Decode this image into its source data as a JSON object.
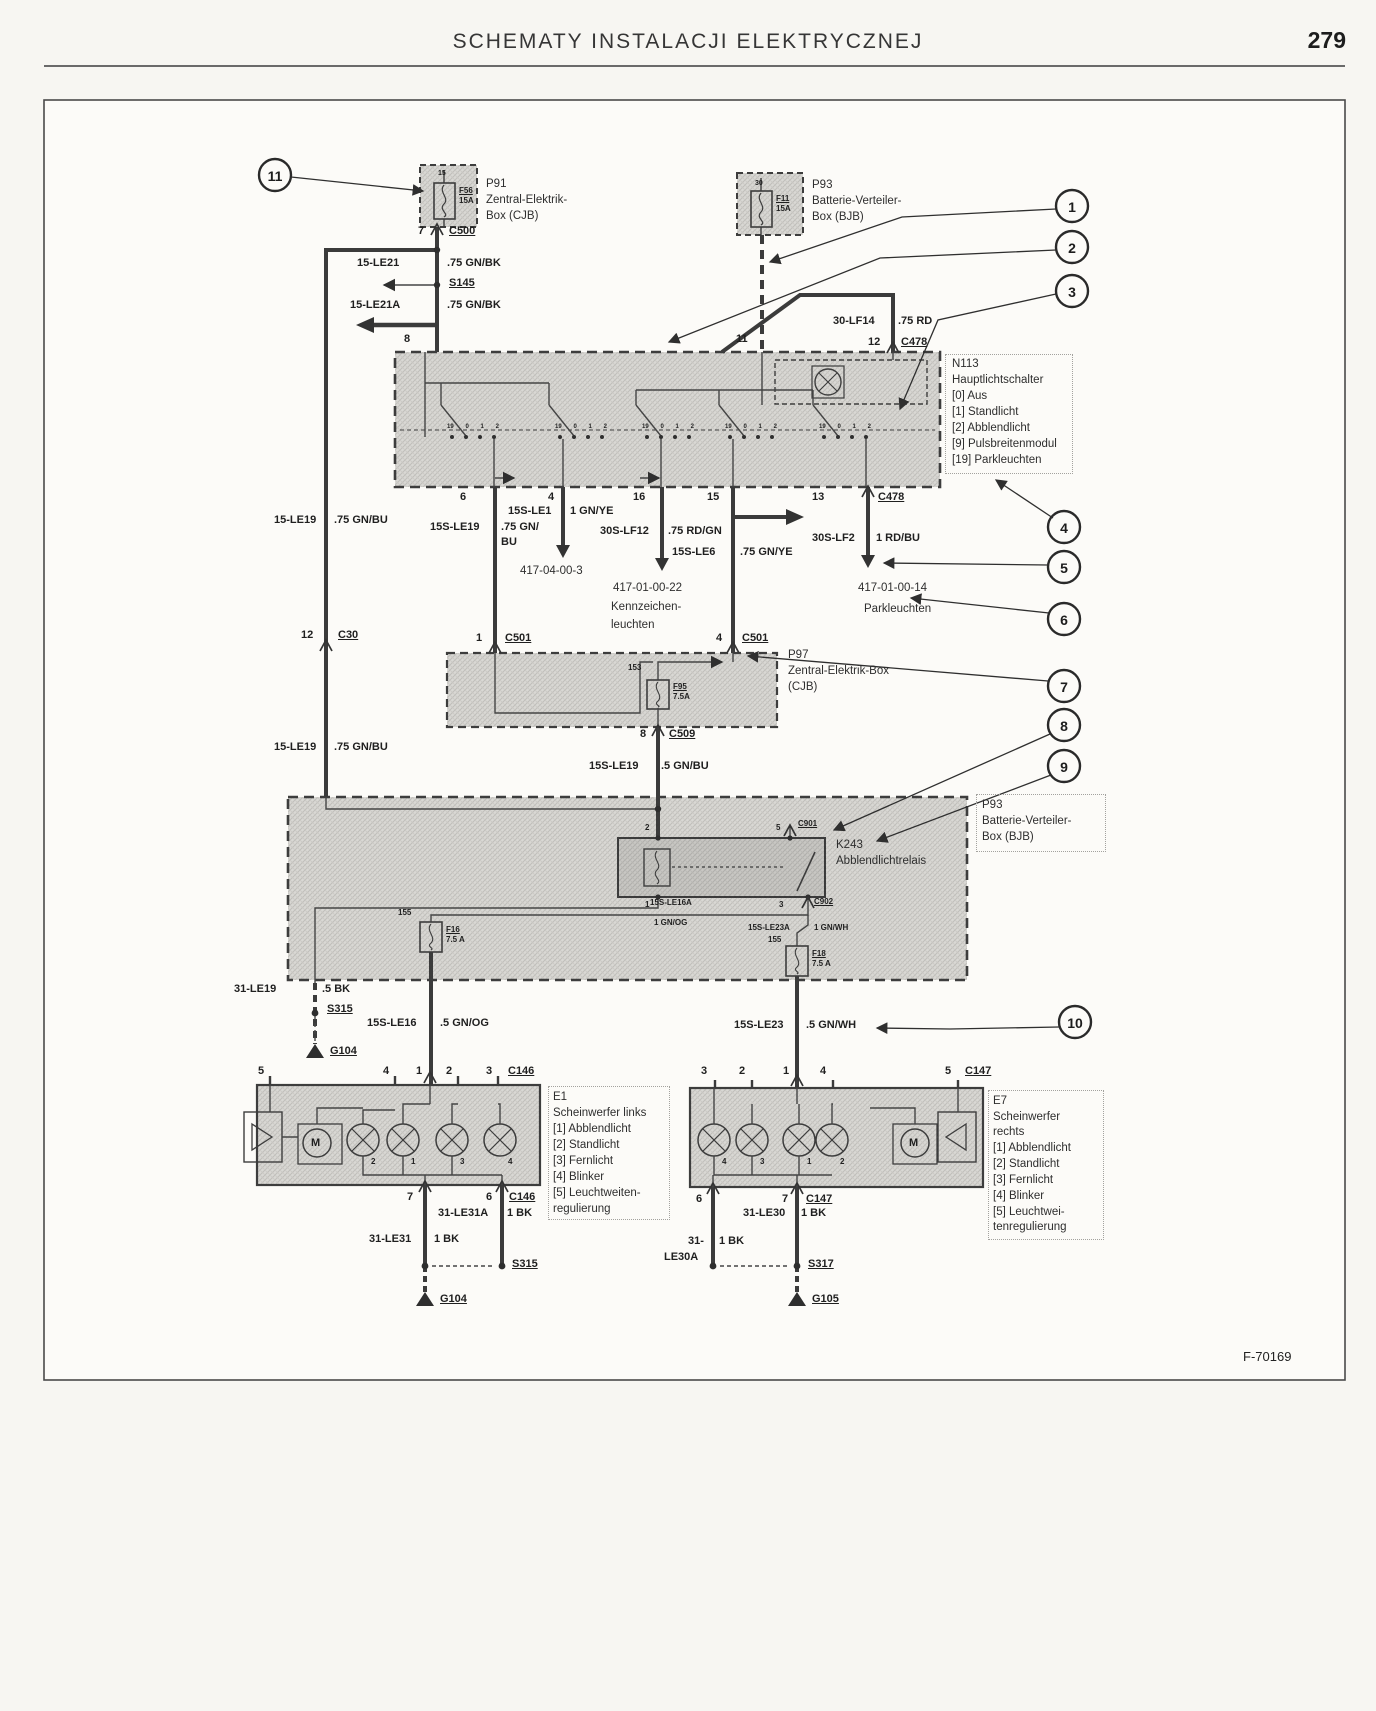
{
  "header": {
    "title": "SCHEMATY INSTALACJI ELEKTRYCZNEJ",
    "page_number": "279"
  },
  "figure": {
    "code": "F-70169"
  },
  "callouts": {
    "c1": "1",
    "c2": "2",
    "c3": "3",
    "c4": "4",
    "c5": "5",
    "c6": "6",
    "c7": "7",
    "c8": "8",
    "c9": "9",
    "c10": "10",
    "c11": "11"
  },
  "boxes": {
    "p91": {
      "name": "P91",
      "desc1": "Zentral-Elektrik-",
      "desc2": "Box (CJB)",
      "fuse": "F56",
      "amps": "15A",
      "pin_top": "15",
      "pin_out": "7",
      "conn_out": "C500"
    },
    "p93_top": {
      "name": "P93",
      "desc1": "Batterie-Verteiler-",
      "desc2": "Box (BJB)",
      "fuse": "F11",
      "amps": "15A",
      "pin_top": "30",
      "pin_in": "11"
    },
    "n113": {
      "name": "N113",
      "title": "Hauptlichtschalter",
      "opt0": "[0] Aus",
      "opt1": "[1] Standlicht",
      "opt2": "[2] Abblendlicht",
      "opt9": "[9] Pulsbreitenmodul",
      "opt19": "[19] Parkleuchten"
    },
    "p97": {
      "name": "P97",
      "desc1": "Zentral-Elektrik-Box",
      "desc2": "(CJB)",
      "fuse": "F95",
      "amps": "7.5A",
      "bus": "153",
      "pin_in_l": "1",
      "conn_in_l": "C501",
      "pin_in_r": "4",
      "conn_in_r": "C501",
      "pin_out": "8",
      "conn_out": "C509"
    },
    "p93_bottom": {
      "name": "P93",
      "desc1": "Batterie-Verteiler-",
      "desc2": "Box (BJB)",
      "bus_l": "155",
      "bus_r": "155",
      "fuse_l": "F16",
      "amps_l": "7.5 A",
      "fuse_r": "F18",
      "amps_r": "7.5 A"
    },
    "k243": {
      "name": "K243",
      "desc": "Abblendlichtrelais",
      "pin2": "2",
      "pin5": "5",
      "pin1": "1",
      "pin3": "3",
      "conn_top": "C901",
      "conn_bottom": "C902"
    },
    "e1": {
      "name": "E1",
      "desc1": "Scheinwerfer links",
      "opt1": "[1] Abblendlicht",
      "opt2": "[2] Standlicht",
      "opt3": "[3] Fernlicht",
      "opt4": "[4] Blinker",
      "opt5a": "[5] Leuchtweiten-",
      "opt5b": "regulierung",
      "pins_top": [
        "5",
        "4",
        "1",
        "2",
        "3"
      ],
      "conn_top": "C146",
      "pins_bottom": [
        "7",
        "6"
      ],
      "conn_bottom": "C146",
      "lamp_nums": [
        "2",
        "1",
        "3",
        "4"
      ],
      "motor": "M"
    },
    "e7": {
      "name": "E7",
      "desc1": "Scheinwerfer",
      "desc2": "rechts",
      "opt1": "[1] Abblendlicht",
      "opt2": "[2] Standlicht",
      "opt3": "[3] Fernlicht",
      "opt4": "[4] Blinker",
      "opt5a": "[5] Leuchtwei-",
      "opt5b": "tenregulierung",
      "pins_top": [
        "3",
        "2",
        "1",
        "4",
        "5"
      ],
      "conn_top": "C147",
      "pins_bottom": [
        "6",
        "7"
      ],
      "conn_bottom": "C147",
      "lamp_nums": [
        "4",
        "3",
        "1",
        "2"
      ],
      "motor": "M"
    }
  },
  "switch": {
    "pin8": "8",
    "pin11": "11",
    "pin12": "12",
    "conn12": "C478",
    "pin6": "6",
    "pin4": "4",
    "pin16": "16",
    "pin15": "15",
    "pin13": "13",
    "conn13": "C478",
    "contacts": [
      "19",
      "0",
      "1",
      "2"
    ]
  },
  "wires": {
    "le21": {
      "name": "15-LE21",
      "spec": ".75 GN/BK"
    },
    "le21a": {
      "name": "15-LE21A",
      "spec": ".75 GN/BK"
    },
    "s145": "S145",
    "lf14": {
      "name": "30-LF14",
      "spec": ".75 RD"
    },
    "le19_a": {
      "name": "15-LE19",
      "spec": ".75 GN/BU"
    },
    "le19_b": {
      "name": "15-LE19",
      "spec": ".75 GN/BU"
    },
    "c30": {
      "pin": "12",
      "name": "C30"
    },
    "sle19": {
      "name": "15S-LE19",
      "spec1": ".75 GN/",
      "spec2": "BU"
    },
    "sle1": {
      "name": "15S-LE1",
      "spec": "1 GN/YE"
    },
    "slf12": {
      "name": "30S-LF12",
      "spec": ".75 RD/GN"
    },
    "sle6": {
      "name": "15S-LE6",
      "spec": ".75 GN/YE"
    },
    "slf2": {
      "name": "30S-LF2",
      "spec": "1 RD/BU"
    },
    "sle19b": {
      "name": "15S-LE19",
      "spec": ".5 GN/BU"
    },
    "sle16a": {
      "name": "15S-LE16A",
      "spec": "1 GN/OG"
    },
    "sle23a": {
      "name": "15S-LE23A",
      "spec": "1 GN/WH"
    },
    "le19g": {
      "name": "31-LE19",
      "spec": ".5 BK"
    },
    "sle16": {
      "name": "15S-LE16",
      "spec": ".5 GN/OG"
    },
    "sle23": {
      "name": "15S-LE23",
      "spec": ".5 GN/WH"
    },
    "le31a": {
      "name": "31-LE31A",
      "spec": "1 BK"
    },
    "le31": {
      "name": "31-LE31",
      "spec": "1 BK"
    },
    "le30": {
      "name": "31-LE30",
      "spec": "1 BK"
    },
    "le30a1": "31-",
    "le30a2": "LE30A",
    "le30a_spec": "1 BK"
  },
  "grounds": {
    "s315a": "S315",
    "g104a": "G104",
    "s315b": "S315",
    "g104b": "G104",
    "s317": "S317",
    "g105": "G105"
  },
  "refs": {
    "r1": "417-04-00-3",
    "r2a": "417-01-00-22",
    "r2b": "Kennzeichen-",
    "r2c": "leuchten",
    "r3a": "417-01-00-14",
    "r3b": "Parkleuchten"
  },
  "colors": {
    "wire": "#3d3d3d",
    "frame": "#4a4a4a"
  }
}
